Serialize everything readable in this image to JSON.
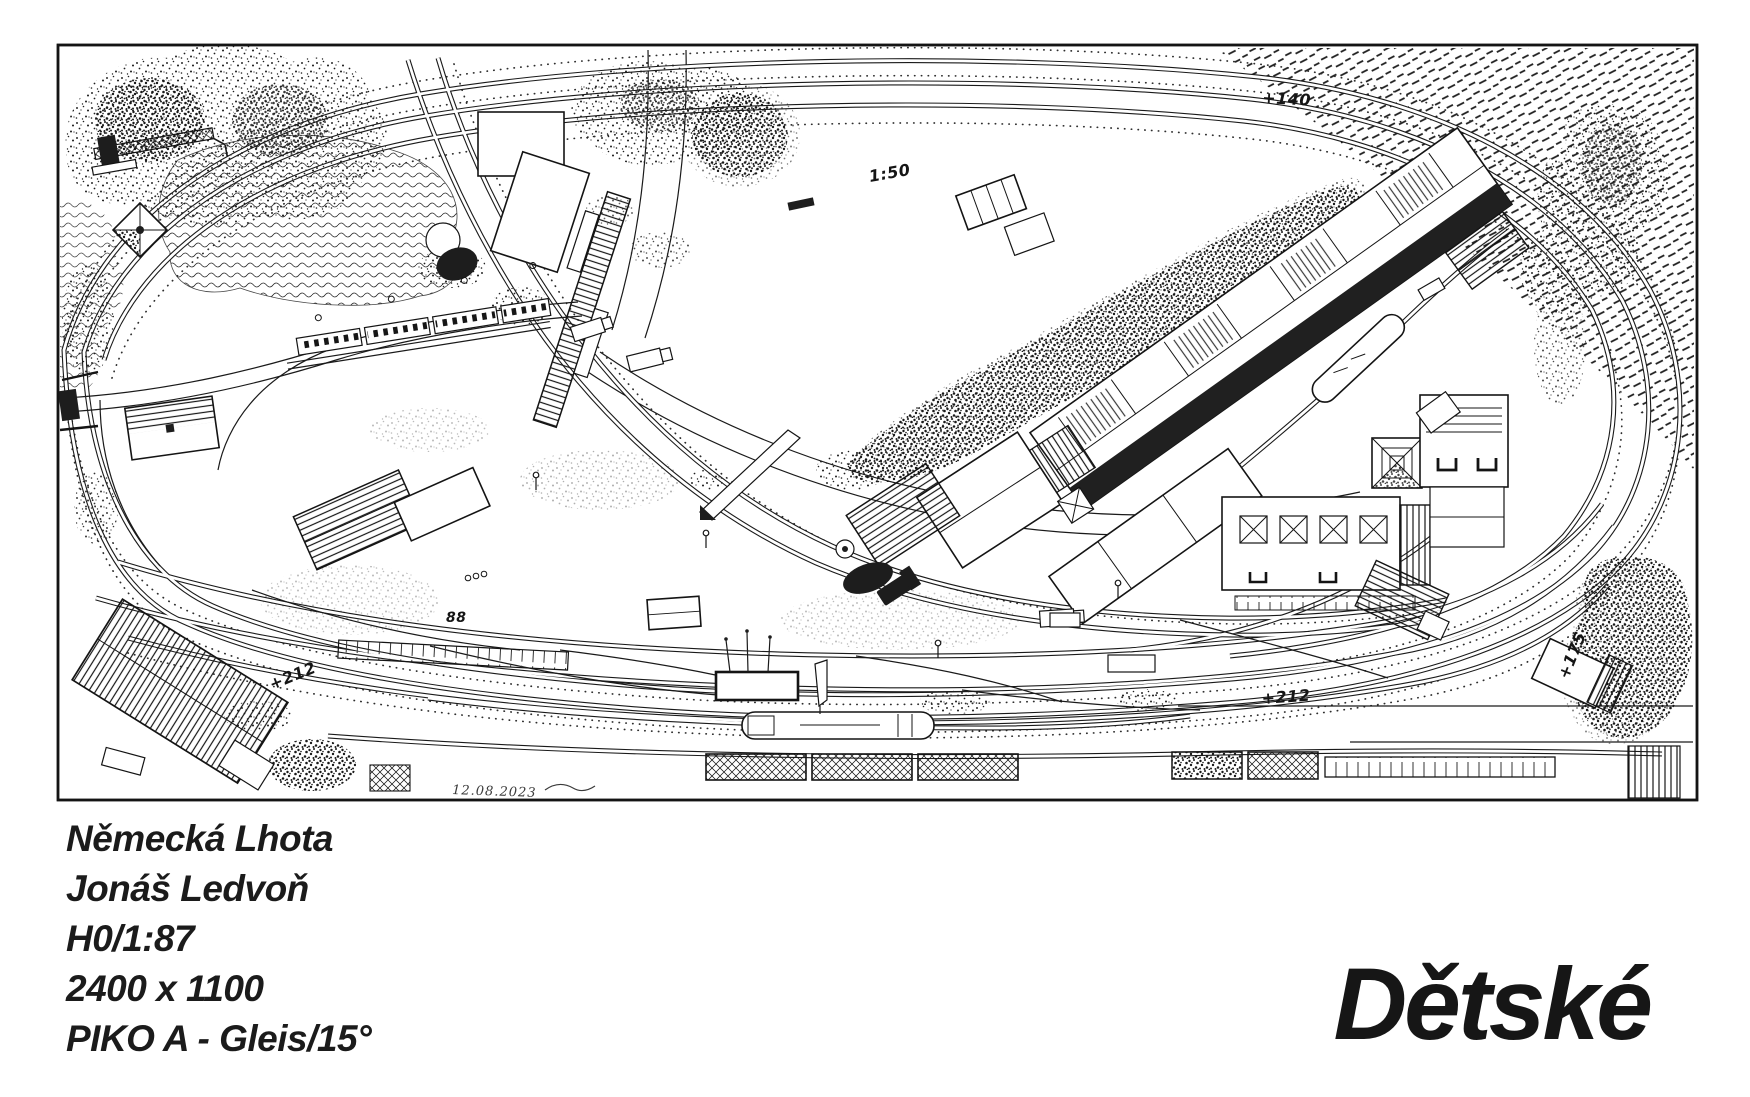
{
  "titleblock": {
    "layout_name": "Německá Lhota",
    "designer": "Jonáš Ledvoň",
    "scale": "H0/1:87",
    "size_mm": "2400 x 1100",
    "track_system": "PIKO A - Gleis/15°",
    "brand": "Dětské"
  },
  "plan_labels": {
    "elevation_top": "+140",
    "gradient_top": "1:50",
    "elevation_left": "+212",
    "elevation_right": "+212",
    "elevation_corner": "+175",
    "building_number": "88",
    "date_signature": "12.08.2023"
  }
}
